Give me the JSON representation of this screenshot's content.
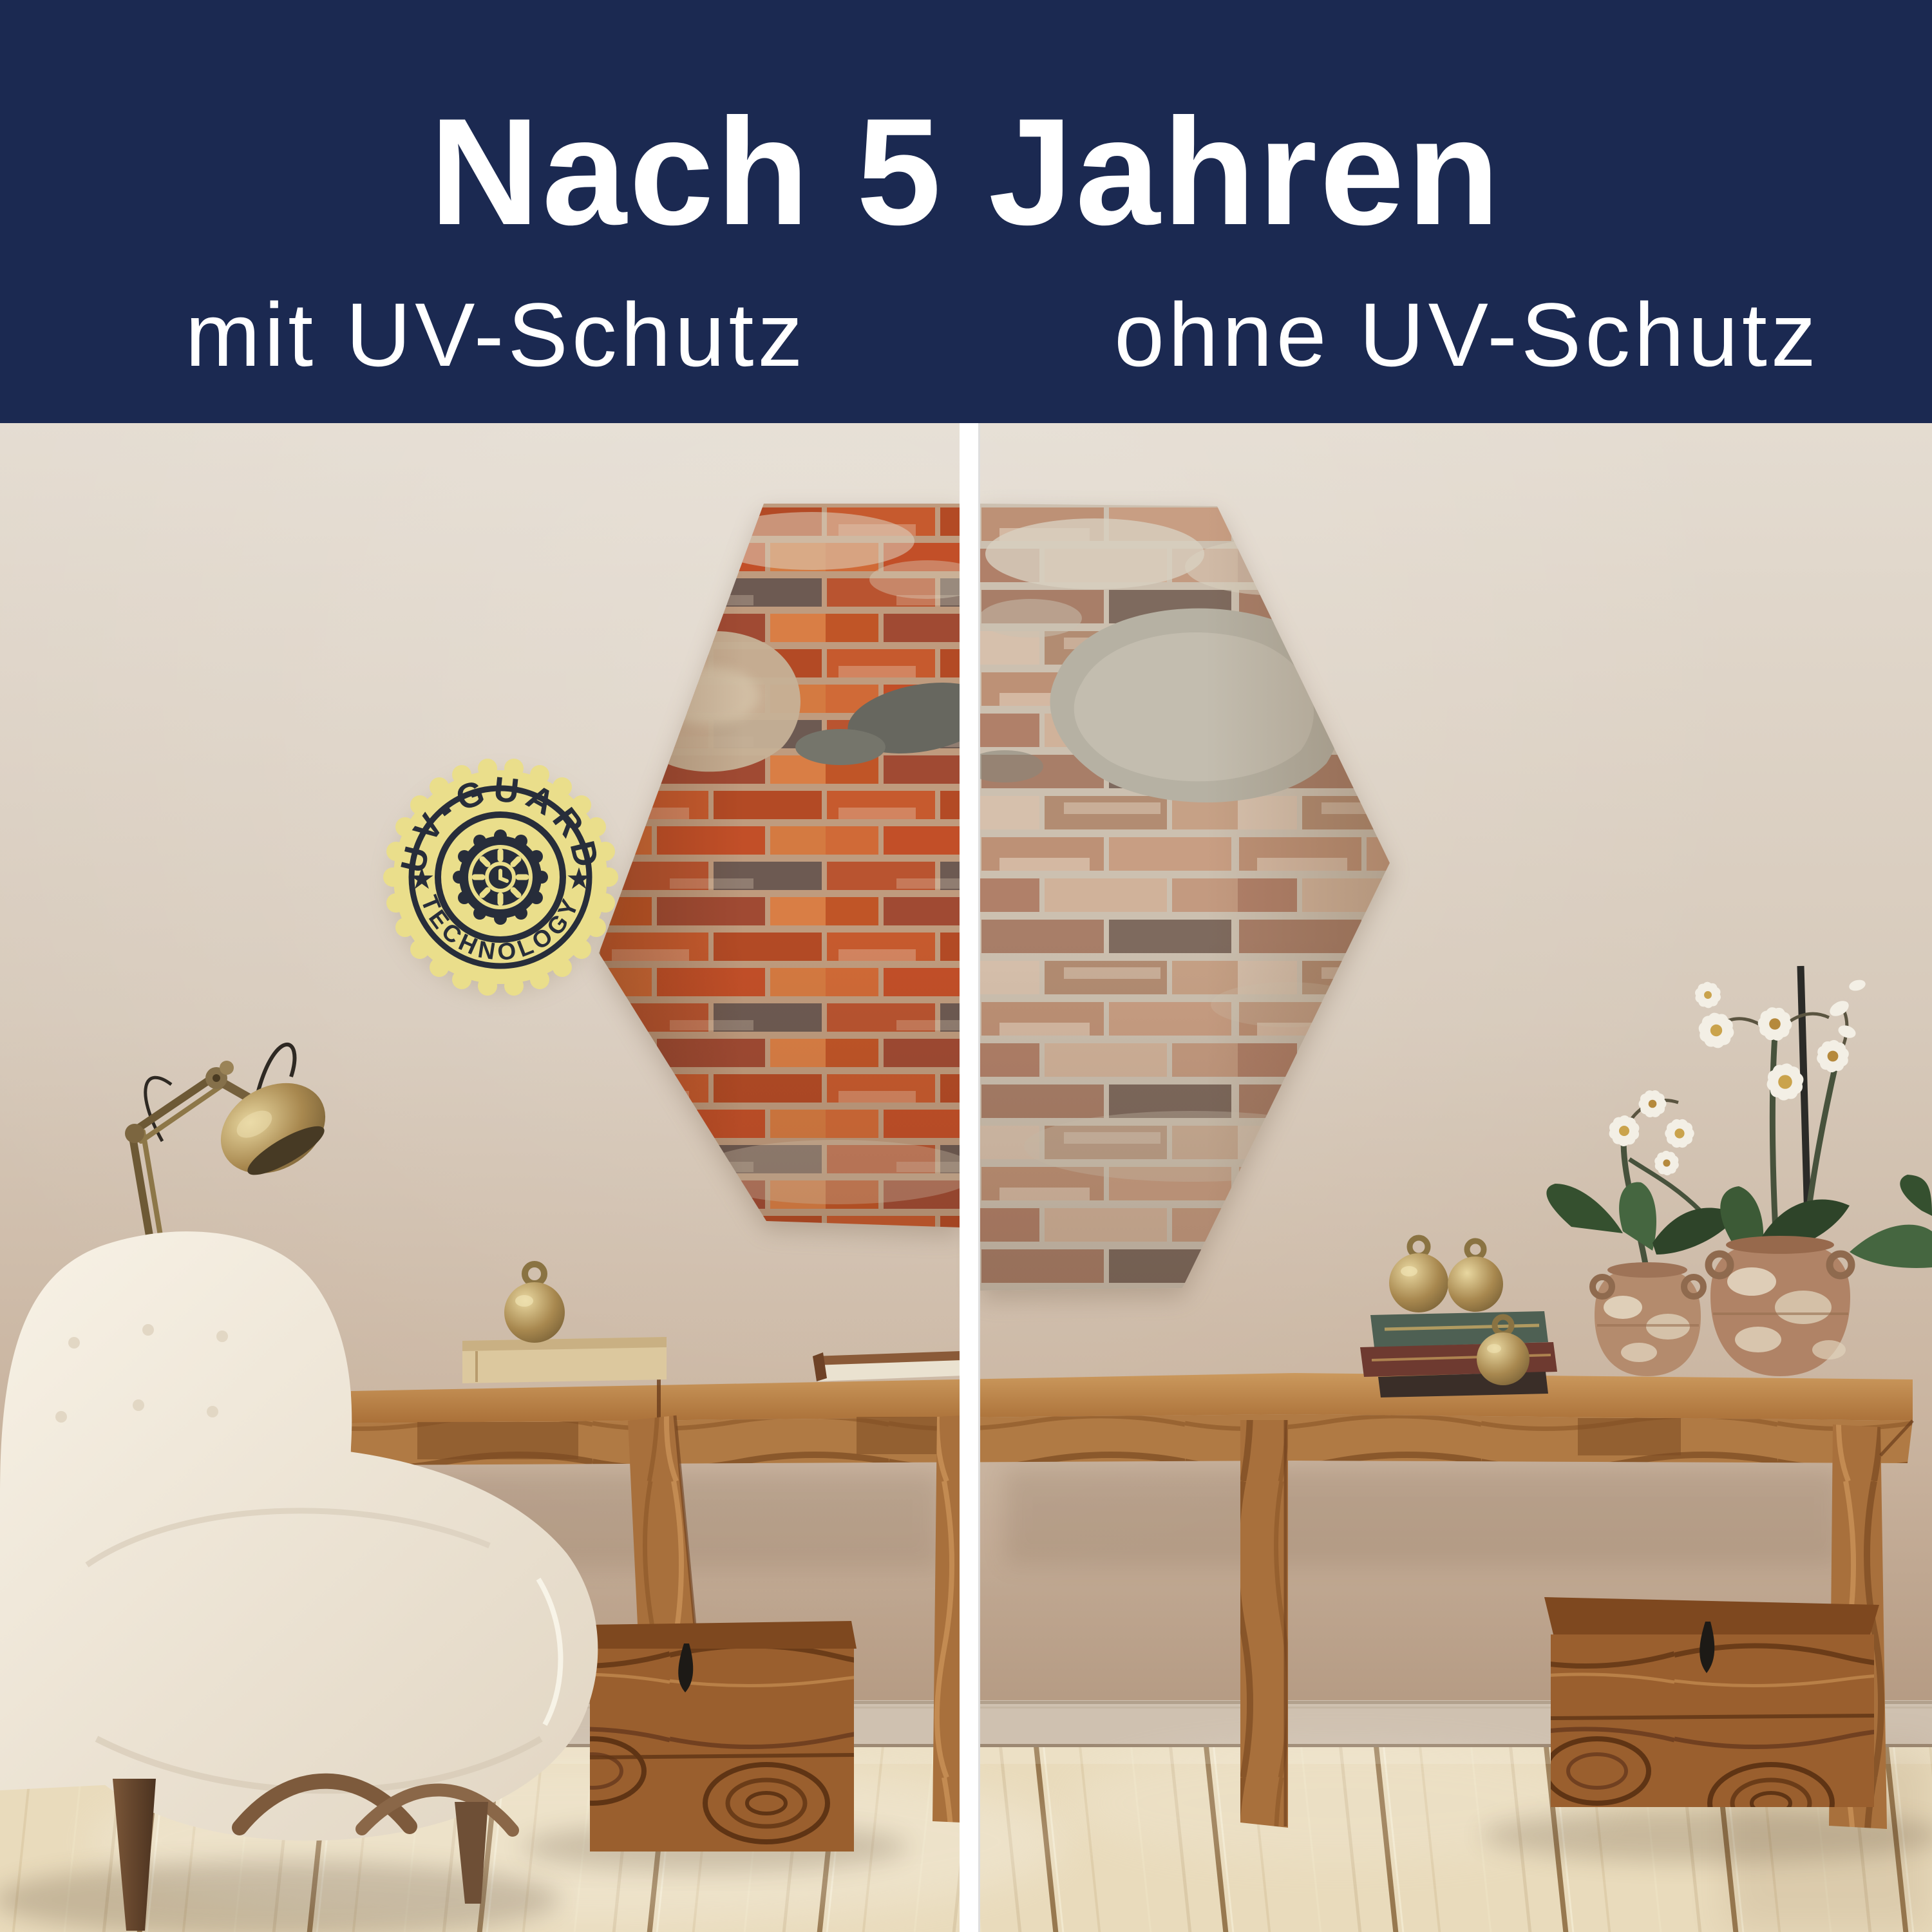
{
  "banner": {
    "title": "Nach 5 Jahren",
    "subtitle_left": "mit UV-Schutz",
    "subtitle_right": "ohne UV-Schutz"
  },
  "badge": {
    "arc_top": "UV-GUARD",
    "arc_bottom": "TECHNOLOGY",
    "star_left": "★",
    "star_right": "★"
  },
  "scene": {
    "objects": [
      "hexagonal-brick-wall-art-left-vibrant",
      "hexagonal-brick-wall-art-right-faded",
      "white-divider-bar",
      "uv-guard-technology-badge",
      "cream-boucle-armchair",
      "brass-desk-lamp",
      "wooden-console-tables",
      "wooden-storage-chests",
      "antique-book-stack",
      "brass-ball-ornaments",
      "terracotta-vases-with-white-orchids",
      "wood-plank-floor"
    ]
  },
  "palette": {
    "banner_navy": "#1b2951",
    "text_white": "#ffffff",
    "divider_white": "#ffffff",
    "badge_yellow": "#eade8b",
    "badge_ink": "#272d3a",
    "wall_light": "#e4dcd1",
    "wall_dark": "#b2977f",
    "brick_mortar_vibrant": "#bf9b7e",
    "brick_mortar_faded": "#ccc0b0",
    "wood_console": "#b07a44",
    "wood_chest": "#9a5f2e",
    "floor_wood": "#e9dbbc",
    "chair_cream": "#f7f1e5",
    "brass": "#a8884f",
    "leaf_green": "#3c5339",
    "orchid_white": "#f3efe5"
  }
}
